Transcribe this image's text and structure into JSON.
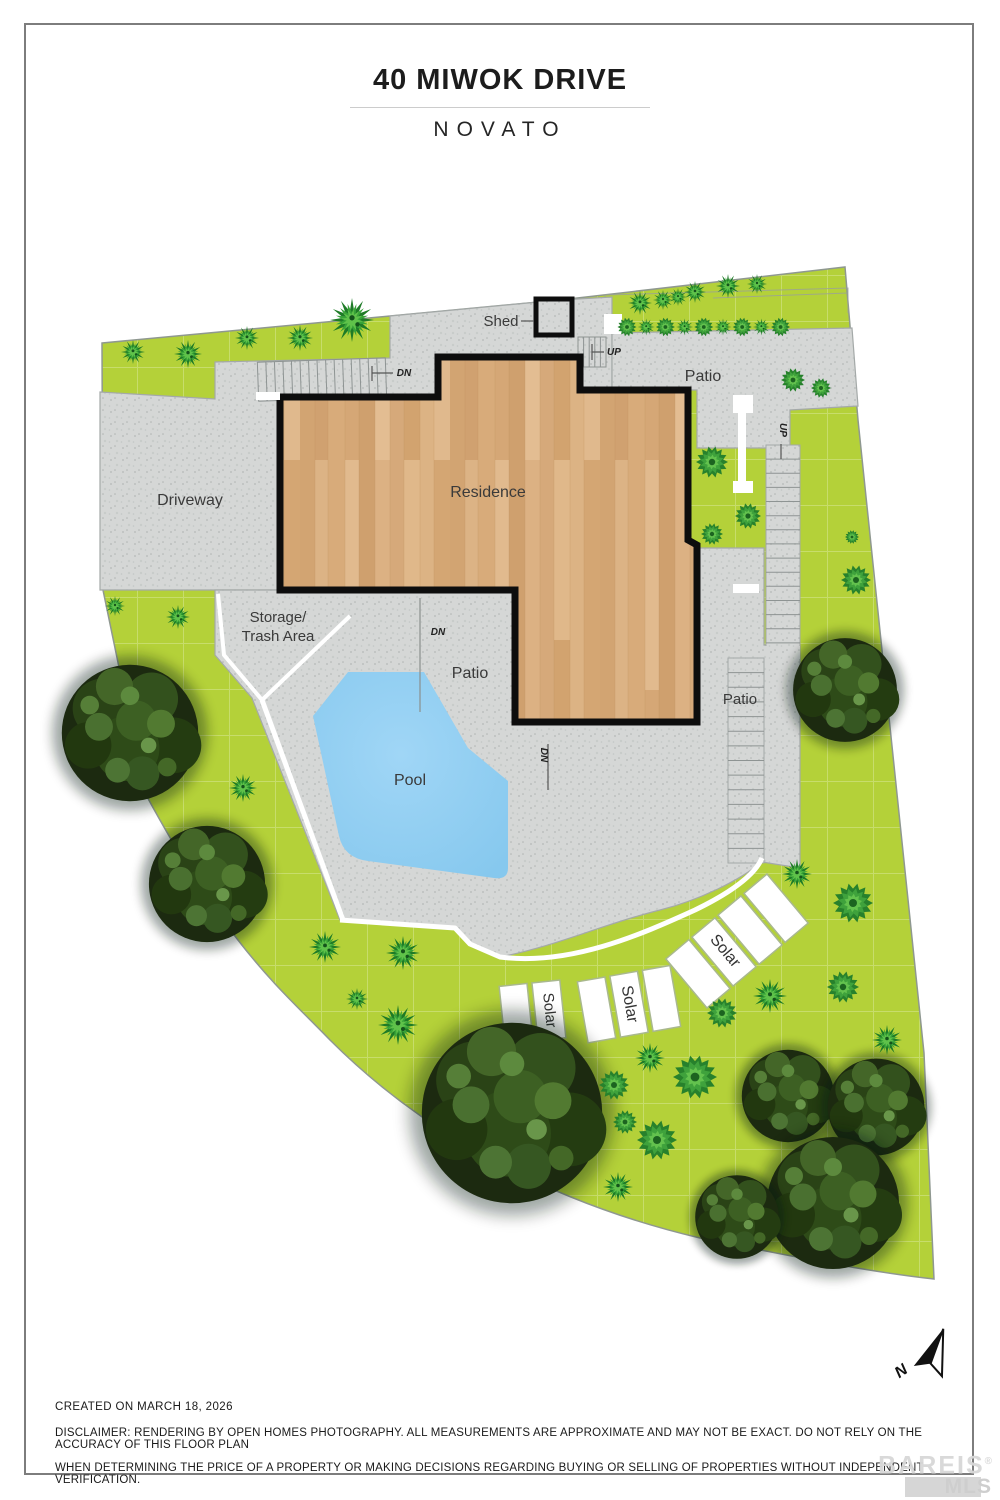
{
  "title": {
    "line1": "40 MIWOK DRIVE",
    "line2": "NOVATO"
  },
  "plan": {
    "areas": {
      "shed": "Shed",
      "patio_top": "Patio",
      "driveway": "Driveway",
      "residence": "Residence",
      "storage_1": "Storage/",
      "storage_2": "Trash Area",
      "patio_mid": "Patio",
      "pool": "Pool",
      "patio_right": "Patio"
    },
    "stairs": {
      "dn": "DN",
      "up": "UP"
    },
    "solar_label": "Solar",
    "compass_n": "N",
    "colors": {
      "grass": "#b4d139",
      "paving": "#d5d7d6",
      "pool_water": "#8ecdf2",
      "wood_floor": "#d9af80",
      "outline": "#0d0d0d"
    }
  },
  "footer": {
    "created": "CREATED ON MARCH 18, 2026",
    "disclaimer1": "DISCLAIMER: RENDERING BY OPEN HOMES PHOTOGRAPHY. ALL MEASUREMENTS ARE APPROXIMATE AND MAY NOT BE EXACT. DO NOT RELY ON THE ACCURACY OF THIS FLOOR PLAN",
    "disclaimer2": "WHEN DETERMINING THE PRICE OF A PROPERTY OR MAKING DECISIONS REGARDING BUYING OR SELLING OF PROPERTIES WITHOUT INDEPENDENT VERIFICATION."
  },
  "watermark": {
    "line1": "BAREIS",
    "reg": "®",
    "line2": "MLS"
  }
}
